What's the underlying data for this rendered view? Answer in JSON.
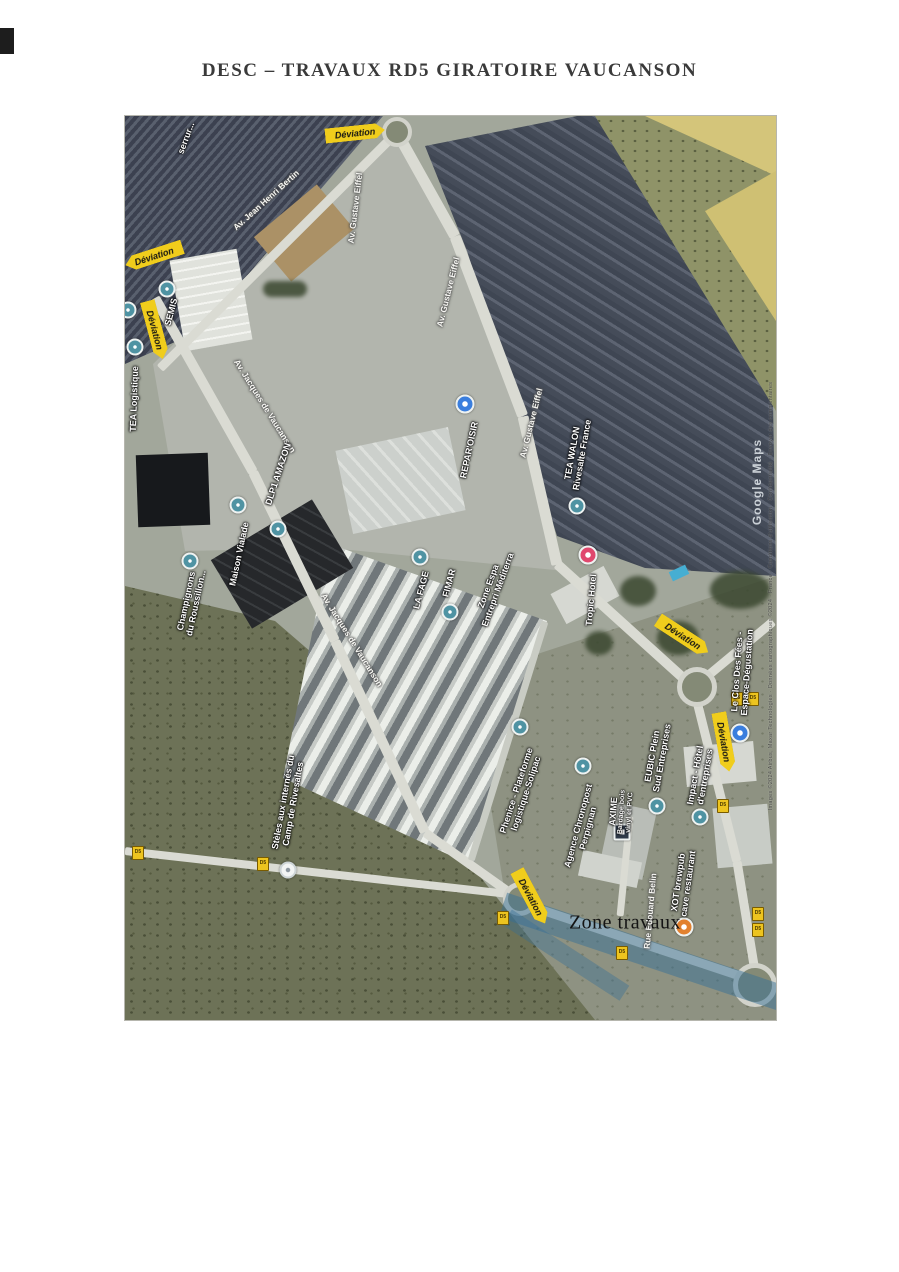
{
  "page": {
    "title": "DESC – TRAVAUX RD5 GIRATOIRE VAUCANSON"
  },
  "map": {
    "detour_label": "Déviation",
    "road_shield": "D5",
    "work_zone_label": "Zone travaux",
    "watermark": "Google Maps",
    "attribution": "Images ©2024 Airbus, Maxar Technologies · Données cartographiques ©2024 · France · Conditions d'utilisation · Confidentialité · Envoyer des commentaires",
    "roads": [
      "Av. Jean Henri Bertin",
      "Av. Gustave Eiffel",
      "Av. Gustave Eiffel",
      "Av. Gustave Eiffel",
      "Av. Jacques de Vaucanson",
      "Av. Jacques de Vaucanson",
      "Rue Édouard Belin"
    ],
    "pois": [
      {
        "lines": [
          "serrur..."
        ]
      },
      {
        "lines": [
          "SEMIS"
        ]
      },
      {
        "lines": [
          "TEA Logistique"
        ]
      },
      {
        "lines": [
          "DLP1 AMAZON"
        ]
      },
      {
        "lines": [
          "Champignons",
          "du Roussillon..."
        ]
      },
      {
        "lines": [
          "Maison Vialade"
        ]
      },
      {
        "lines": [
          "LA FAGE"
        ]
      },
      {
        "lines": [
          "FIMAR"
        ]
      },
      {
        "lines": [
          "REPAR'OISIR"
        ]
      },
      {
        "lines": [
          "Zone Espa",
          "Entrepri Méditerra"
        ]
      },
      {
        "lines": [
          "TEA WALON",
          "Rivesalte France"
        ]
      },
      {
        "lines": [
          "Tropic Hotel"
        ]
      },
      {
        "lines": [
          "Le Clos Des Fées -",
          "Espace-Dégustation"
        ]
      },
      {
        "lines": [
          "Phenice - Plateforme",
          "logistique-Solipac"
        ]
      },
      {
        "lines": [
          "Agence Chronopost",
          "Perpignan"
        ]
      },
      {
        "lines": [
          "AXIME"
        ],
        "sub": [
          "Bardage bois",
          "vinyl et PVC"
        ]
      },
      {
        "lines": [
          "EUBIC Plein",
          "Sud Entreprises"
        ]
      },
      {
        "lines": [
          "Impact - Hôtel",
          "d'entreprises"
        ]
      },
      {
        "lines": [
          "XOT brewpub",
          "cave restaurant"
        ]
      },
      {
        "lines": [
          "Stèles aux internés du",
          "Camp de Rivesaltes"
        ]
      }
    ],
    "icons": {
      "poi_marker": "teal-dot",
      "hotel_marker": "pink-circle",
      "restaurant_marker": "orange-circle",
      "shop_marker": "blue-circle",
      "company_marker": "dark-square",
      "memorial_marker": "white-dot",
      "detour_sign": "yellow-arrow-banner"
    }
  }
}
